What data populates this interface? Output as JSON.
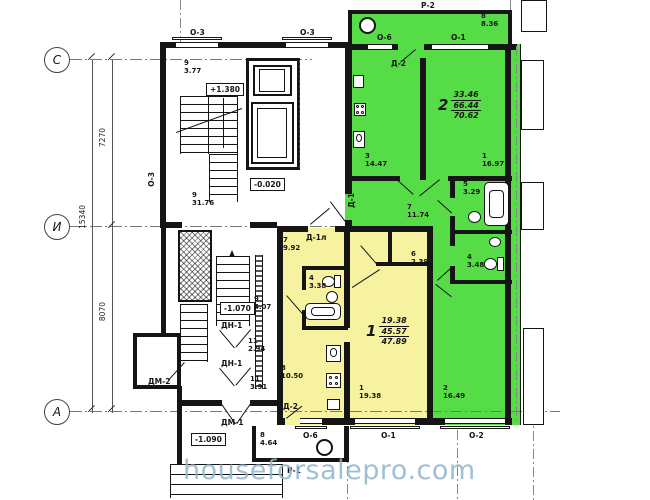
{
  "watermark": "houseforsalepro.com",
  "colors": {
    "apartment_green_fill": "#56DC47",
    "apartment_yellow_fill": "#F6F2A0",
    "wall": "#151515",
    "watermark_text": "#8FB6CB"
  },
  "axes": {
    "c": "С",
    "i": "И",
    "a": "А",
    "dim_total": "15340",
    "dim_upper": "7270",
    "dim_lower": "8070"
  },
  "openings": {
    "o3_top_left": "О-3",
    "o3_top_right": "О-3",
    "o3_left_wall": "О-3",
    "p2": "Р-2",
    "o6_balcony": "О-6",
    "o1_balcony": "О-1",
    "o6_bottom": "О-6",
    "o1_bottom": "О-1",
    "o2_bottom": "О-2",
    "p1": "Р-1"
  },
  "doors": {
    "d2_green": "Д-2",
    "d1_green": "Д-1",
    "d1l_yellow": "Д-1л",
    "d2_yellow": "Д-2",
    "dn1_upper": "ДН-1",
    "dn1_lower": "ДН-1",
    "dm2": "ДМ-2",
    "dm1": "ДМ-1"
  },
  "elevations": {
    "stair_landing": "+1.380",
    "entry_level": "-0.020",
    "lower_landing": "-1.070",
    "porch": "-1.090"
  },
  "apartment_green": {
    "number": "2",
    "area_living": "33.46",
    "area_apartment": "66.44",
    "area_total": "70.62",
    "rooms": {
      "balcony": {
        "num": "8",
        "area": "8.36"
      },
      "kitchen": {
        "num": "3",
        "area": "14.47"
      },
      "living": {
        "num": "1",
        "area": "16.97"
      },
      "bath": {
        "num": "5",
        "area": "3.29"
      },
      "wc": {
        "num": "4",
        "area": "3.48"
      },
      "hall": {
        "num": "7",
        "area": "11.74"
      },
      "bedroom": {
        "num": "2",
        "area": "16.49"
      }
    }
  },
  "apartment_yellow": {
    "number": "1",
    "area_living": "19.38",
    "area_apartment": "45.57",
    "area_total": "47.89",
    "rooms": {
      "hall": {
        "num": "7",
        "area": "9.92"
      },
      "bath": {
        "num": "4",
        "area": "3.38"
      },
      "closet": {
        "num": "6",
        "area": "2.39"
      },
      "kitchen": {
        "num": "3",
        "area": "10.50"
      },
      "living": {
        "num": "1",
        "area": "19.38"
      },
      "balcony": {
        "num": "8",
        "area": "4.64"
      }
    }
  },
  "common_areas": {
    "stair_upper": {
      "num": "9",
      "area": "3.77"
    },
    "lobby": {
      "num": "9",
      "area": "31.76"
    },
    "stair_lower": {
      "num": "9",
      "area": "4.07"
    },
    "vestibule_upper": {
      "num": "11",
      "area": "2.94"
    },
    "vestibule_lower": {
      "num": "11",
      "area": "3.91"
    }
  }
}
